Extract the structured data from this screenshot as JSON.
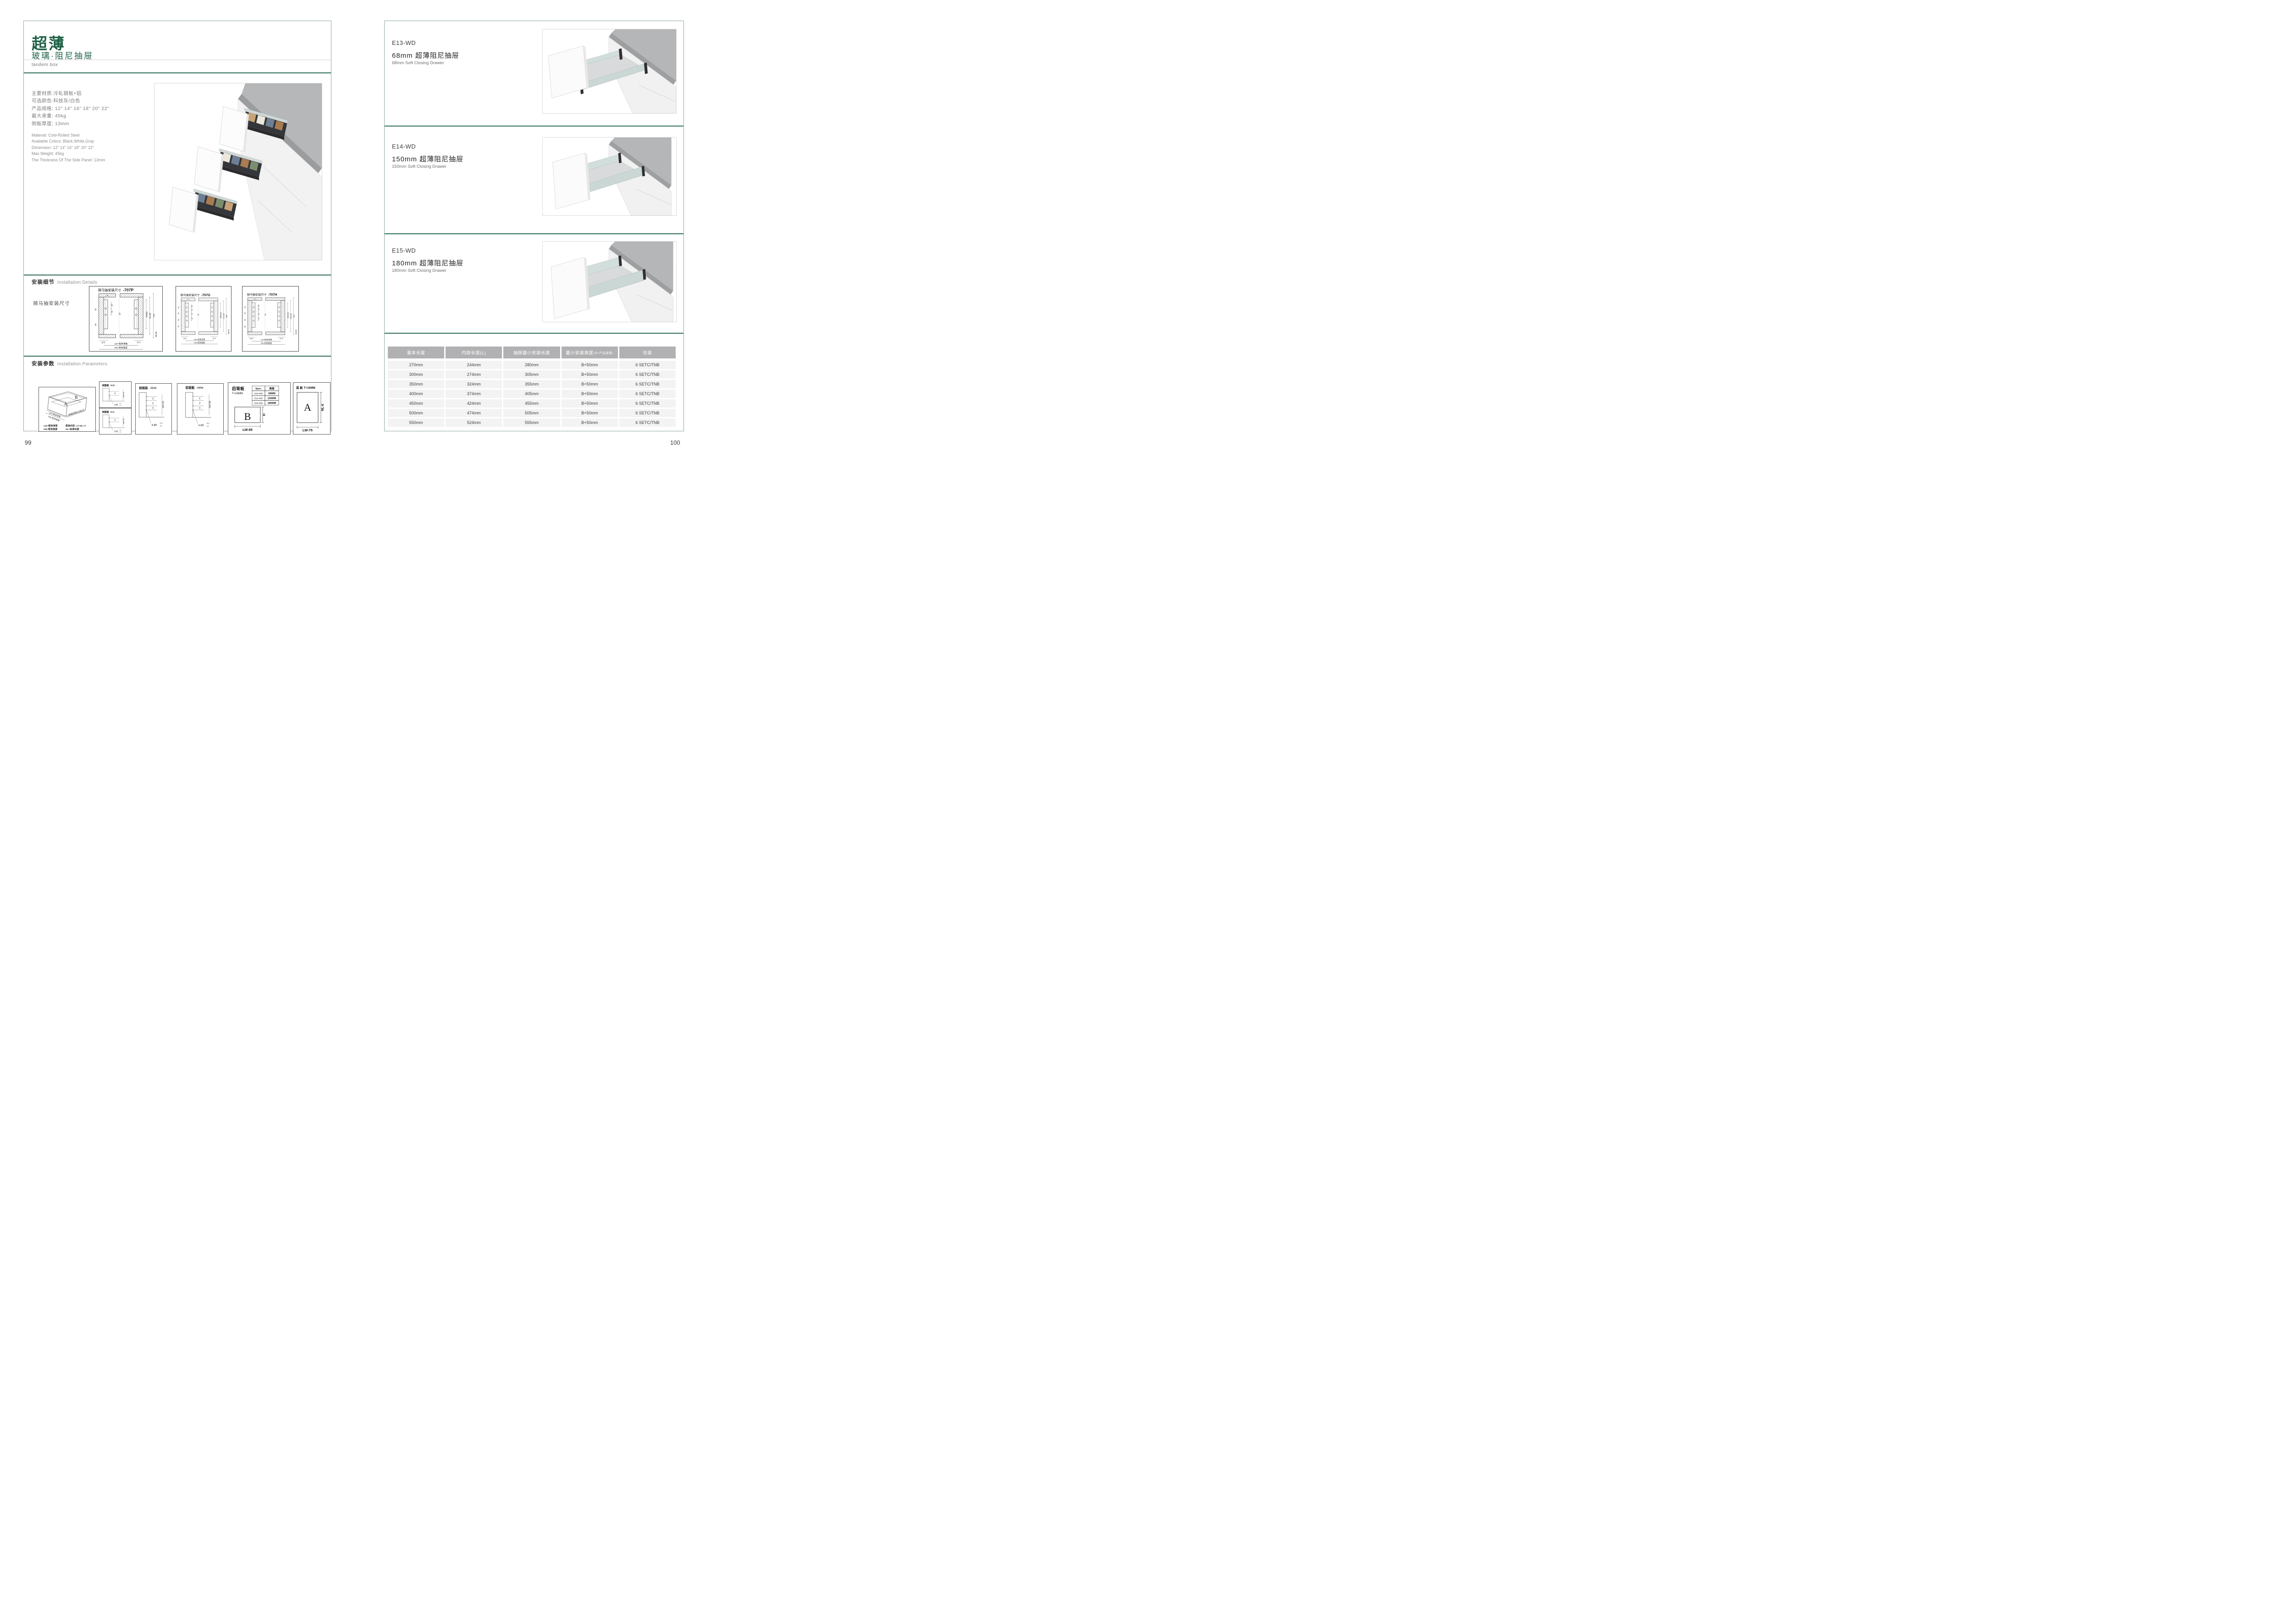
{
  "left": {
    "page_number": "99",
    "title": "超薄",
    "subtitle": "玻璃·阻尼抽屉",
    "subtitle_en": "tandem box",
    "specs_cn": [
      "主要材质:冷轧钢板+铝",
      "可选颜色:科技灰/白色",
      "产品规格: 12\" 14\" 16\" 18\" 20\" 22\"",
      "最大承重: 45kg",
      "侧板厚度; 13mm"
    ],
    "specs_en": [
      "Material: Cold-Rolled Steel",
      "Available Colors: Black,White,Gray",
      "Dimension: 12\" 14\" 16\" 18\" 20\" 22\"",
      "Max Weight: 45kg",
      "The Thickness Of The Side Panel: 13mm"
    ],
    "details_label_cn": "安装细节",
    "details_label_en": "Installation Details",
    "details_sublabel": "骑马抽安装尺寸",
    "params_label_cn": "安装参数",
    "params_label_en": "Installation Parameters",
    "cad": [
      {
        "title": "骑马抽安装尺寸",
        "model": "-707P",
        "top": "9",
        "holes": [
          "20",
          "32"
        ],
        "left_dims": [
          "32",
          "54"
        ],
        "center": "16",
        "right_dims": [
          "Min82",
          "91.50",
          "113"
        ],
        "b1": "16.5",
        "b2": "37.5",
        "b3": "Min36",
        "lw": "LW=柜体净宽",
        "kb": "KB=柜体宽度"
      },
      {
        "title": "骑马抽安装尺寸",
        "model": "-707G",
        "top": "9",
        "holes": [
          "20",
          "32",
          "32",
          "32"
        ],
        "left_dims": [
          "32",
          "64",
          "32",
          "54"
        ],
        "center": "16",
        "right_dims": [
          "Min162",
          "171.50",
          "195"
        ],
        "b1": "16.5",
        "b2": "37.5",
        "b3": "Min36",
        "lw": "LW=柜体净宽",
        "kb": "KB=柜体宽度"
      },
      {
        "title": "骑马抽安装尺寸",
        "model": "-707H",
        "top": "9",
        "holes": [
          "20",
          "32",
          "32",
          "32"
        ],
        "left_dims": [
          "32",
          "64",
          "32",
          "54"
        ],
        "center": "16",
        "right_dims": [
          "Min192",
          "201.50",
          "225"
        ],
        "b1": "16.5",
        "b2": "37.5",
        "b3": "Min36",
        "lw": "LW=柜体净宽",
        "kb": "KB=柜体宽度"
      }
    ],
    "iso": {
      "a": "A",
      "b": "B",
      "lw": "LW=柜体净宽",
      "kb": "KB=柜体宽度",
      "lt": "柜体内空LT=NL+3",
      "legend1a": "LW=柜体净宽",
      "legend1b": "柜体内空: LT=NL+3",
      "legend2a": "KB=柜体宽度",
      "legend2b": "NL=标准长度"
    },
    "front_panels": [
      {
        "title": "前面板",
        "model": "-707P",
        "dims": [
          "32"
        ],
        "min": "min 54",
        "callout": "2-Ø2",
        "tol_up": "+0.2",
        "tol_dn": "-0.1"
      },
      {
        "title": "前面板",
        "model": "-707L",
        "dims": [
          "32"
        ],
        "min": "min 54",
        "callout": "2-Ø2",
        "tol_up": "+0.2",
        "tol_dn": "-0.1"
      },
      {
        "title": "前面板",
        "model": "-707G",
        "dims": [
          "32",
          "64",
          "32"
        ],
        "min": "min 54",
        "callout": "4-Ø2",
        "tol_up": "+0.2",
        "tol_dn": "-0.1"
      },
      {
        "title": "前面板",
        "model": "-707H",
        "dims": [
          "32",
          "64",
          "32"
        ],
        "min": "min 54",
        "callout": "4-Ø2",
        "tol_up": "+0.2",
        "tol_dn": "-0.1"
      }
    ],
    "back_panel": {
      "title": "后背板",
      "t": "T=16MM",
      "spec_header": [
        "Spec.",
        "高度"
      ],
      "spec_rows": [
        [
          "E13-WD",
          "68MM"
        ],
        [
          "E14-WD",
          "150MM"
        ],
        [
          "E15-WD",
          "180MM"
        ]
      ],
      "label": "B",
      "h": "H",
      "lw": "LW-85"
    },
    "bottom_panel": {
      "title": "底 板 T=16MM",
      "label": "A",
      "nl": "NL-6",
      "lw": "LW-75"
    }
  },
  "right": {
    "page_number": "100",
    "sections": [
      {
        "code": "E13-WD",
        "name_cn": "68mm 超薄阻尼抽屉",
        "name_en": "68mm Soft Closing Drawer"
      },
      {
        "code": "E14-WD",
        "name_cn": "150mm 超薄阻尼抽屉",
        "name_en": "150mm Soft Closing Drawer"
      },
      {
        "code": "E15-WD",
        "name_cn": "180mm 超薄阻尼抽屉",
        "name_en": "180mm Soft Closing Drawer"
      }
    ],
    "table": {
      "headers": [
        "基本长度",
        "内部长度(L)",
        "抽屉最小安装长度",
        "最小安装高度",
        "包装"
      ],
      "header_suffix": "(B=产品高度)",
      "rows": [
        [
          "270mm",
          "244mm",
          "280mm",
          "B+50mm",
          "6 SETC/TNB"
        ],
        [
          "300mm",
          "274mm",
          "305mm",
          "B+50mm",
          "6 SETC/TNB"
        ],
        [
          "350mm",
          "324mm",
          "355mm",
          "B+50mm",
          "6 SETC/TNB"
        ],
        [
          "400mm",
          "374mm",
          "405mm",
          "B+50mm",
          "6 SETC/TNB"
        ],
        [
          "450mm",
          "424mm",
          "455mm",
          "B+50mm",
          "6 SETC/TNB"
        ],
        [
          "500mm",
          "474mm",
          "505mm",
          "B+50mm",
          "6 SETC/TNB"
        ],
        [
          "550mm",
          "524mm",
          "555mm",
          "B+50mm",
          "6 SETC/TNB"
        ]
      ]
    }
  },
  "colors": {
    "brand_green": "#1e6146",
    "divider_green": "#2e6b55",
    "table_header_bg": "#b1b1b3",
    "table_row_bg": "#f3f3f4"
  }
}
